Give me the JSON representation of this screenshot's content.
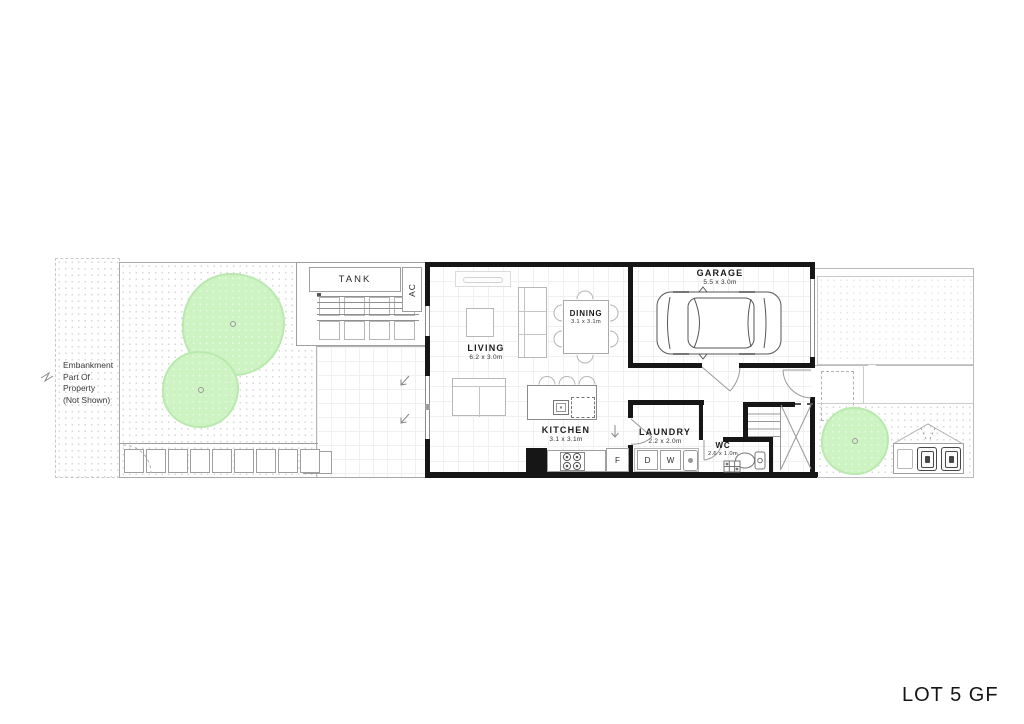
{
  "title": "LOT 5 GF",
  "embankment_note": {
    "line1": "Embankment",
    "line2": "Part Of",
    "line3": "Property",
    "line4": "(Not Shown)"
  },
  "rooms": {
    "living": {
      "name": "LIVING",
      "dims": "6.2 x 3.0m"
    },
    "dining": {
      "name": "DINING",
      "dims": "3.1 x 3.1m"
    },
    "kitchen": {
      "name": "KITCHEN",
      "dims": "3.1 x 3.1m"
    },
    "garage": {
      "name": "GARAGE",
      "dims": "5.5 x 3.0m"
    },
    "laundry": {
      "name": "LAUNDRY",
      "dims": "2.2 x 2.0m"
    },
    "wc": {
      "name": "WC",
      "dims": "2.6 x 1.0m"
    }
  },
  "labels": {
    "tank": "TANK",
    "ac": "AC",
    "fridge": "F",
    "dryer": "D",
    "washer": "W"
  },
  "colors": {
    "wall": "#161616",
    "tree_fill": "#cdf3c3",
    "tree_edge": "#b9e9ae",
    "line": "#9a9a9a"
  }
}
